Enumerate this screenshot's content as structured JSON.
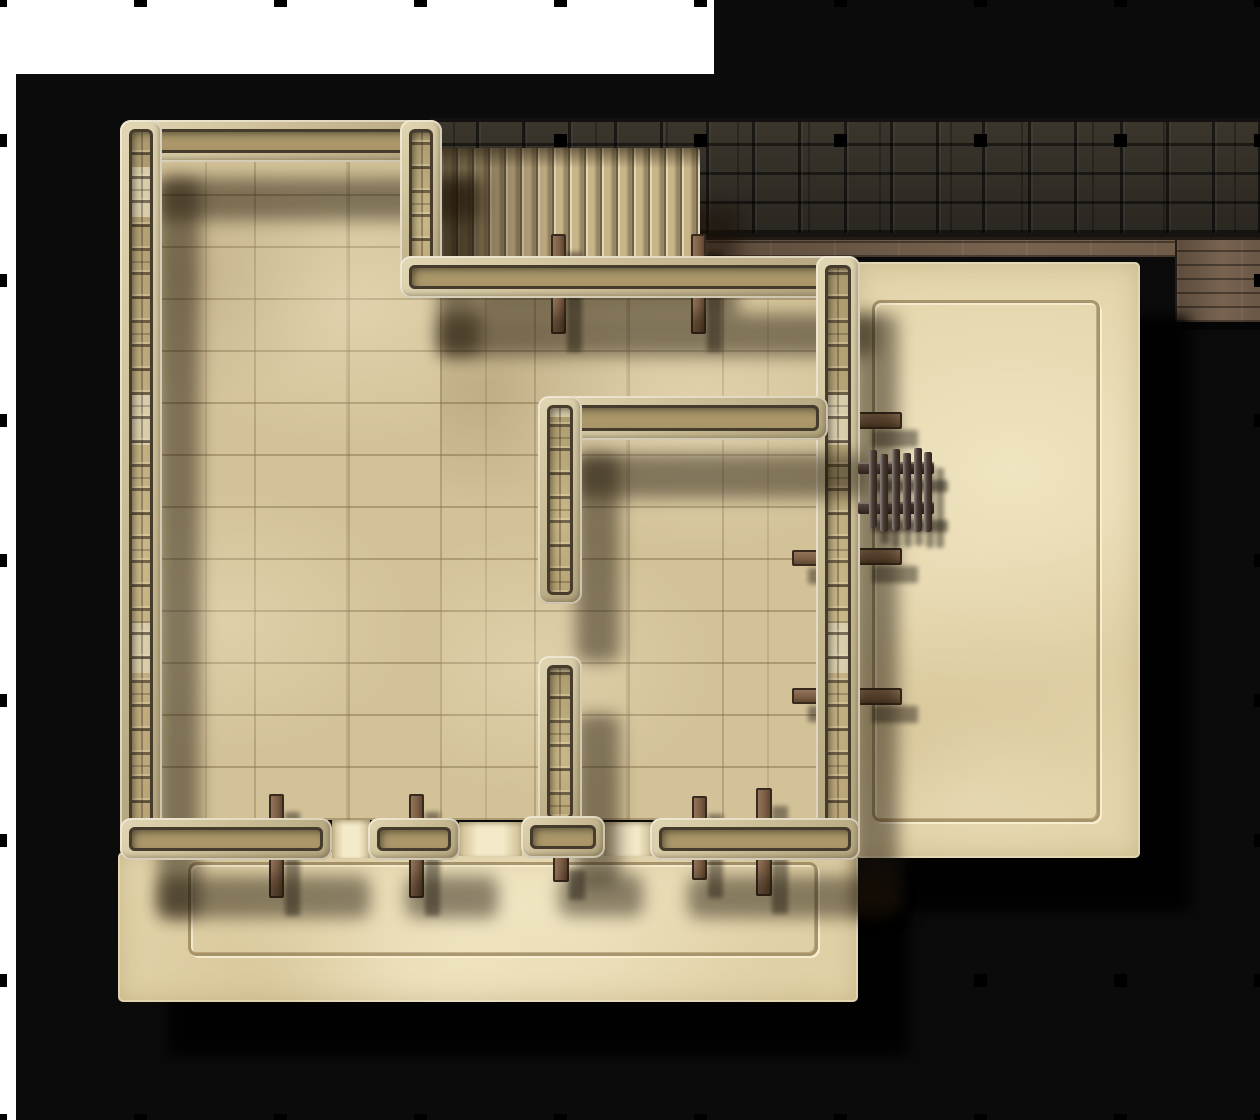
{
  "scene": {
    "description": "Top-down stone keep battle map: large tiled hall with staircase, inner chamber, sandy terrace and walled courtyard, dark stone perimeter wall with wooden walkway, black backdrop with square grid markers",
    "canvas": {
      "width": 1260,
      "height": 1120
    },
    "grid": {
      "cell_px": 140,
      "cols": 9,
      "rows": 8,
      "marker_size_px": 13,
      "marker_color": "#000000"
    },
    "background": {
      "page_color": "#ffffff",
      "backdrop_color": "#0b0b0b",
      "white_top_band": {
        "x": 0,
        "y": 0,
        "w": 714,
        "h": 74
      },
      "white_left_strip_w": 16
    }
  },
  "palette": {
    "floor_tile": "#d3c298",
    "floor_sand": "#e3d4aa",
    "wall_stone_light": "#e2d7b4",
    "wall_brick": "#ab9769",
    "wall_seam": "#453c2d",
    "perimeter_brick": "#322d25",
    "walkway_wood": "#6b5949",
    "post_wood": "#7a5d44",
    "fence_wood": "#3c2e28",
    "shadow": "#000000"
  },
  "layers": {
    "below_grid": [
      {
        "name": "backdrop-main",
        "cls": "bg-black",
        "rect": [
          16,
          74,
          1244,
          1046
        ]
      },
      {
        "name": "backdrop-top-right",
        "cls": "bg-black",
        "rect": [
          714,
          0,
          546,
          74
        ]
      },
      {
        "name": "perimeter-brick-wall",
        "cls": "brick-band",
        "rect": [
          430,
          118,
          830,
          120
        ]
      },
      {
        "name": "wood-walkway",
        "cls": "wood",
        "rect": [
          706,
          237,
          554,
          20
        ]
      },
      {
        "name": "wood-walkway-block",
        "cls": "wood wood-block",
        "rect": [
          1175,
          237,
          85,
          85
        ]
      }
    ],
    "above_grid": [
      {
        "name": "main-hall-floor-west",
        "cls": "floor-tiles",
        "rect": [
          160,
          160,
          280,
          660
        ]
      },
      {
        "name": "main-hall-floor-east",
        "cls": "floor-tiles",
        "rect": [
          440,
          298,
          380,
          522
        ]
      },
      {
        "name": "terrace-floor",
        "cls": "floor-sand shadow-big",
        "rect": [
          118,
          852,
          740,
          150
        ]
      },
      {
        "name": "courtyard-floor",
        "cls": "floor-sand shadow-big",
        "rect": [
          855,
          262,
          285,
          596
        ]
      },
      {
        "name": "terrace-groove-border",
        "cls": "groove",
        "rect": [
          188,
          862,
          630,
          94
        ]
      },
      {
        "name": "courtyard-groove-border",
        "cls": "groove",
        "rect": [
          872,
          300,
          228,
          522
        ]
      },
      {
        "name": "door-threshold-west",
        "cls": "threshold",
        "rect": [
          332,
          820,
          38,
          38
        ]
      },
      {
        "name": "door-threshold-middle",
        "cls": "threshold",
        "rect": [
          459,
          822,
          63,
          34
        ]
      },
      {
        "name": "door-threshold-east",
        "cls": "threshold",
        "rect": [
          604,
          822,
          48,
          34
        ]
      },
      {
        "name": "staircase",
        "cls": "stairs shadow-wall",
        "rect": [
          442,
          148,
          258,
          110
        ]
      },
      {
        "name": "post-north-1",
        "cls": "post",
        "rect": [
          551,
          234,
          15,
          100
        ]
      },
      {
        "name": "post-north-2",
        "cls": "post",
        "rect": [
          691,
          234,
          15,
          100
        ]
      },
      {
        "name": "post-south-1",
        "cls": "post",
        "rect": [
          269,
          794,
          15,
          104
        ]
      },
      {
        "name": "post-south-2",
        "cls": "post",
        "rect": [
          409,
          794,
          15,
          104
        ]
      },
      {
        "name": "post-south-3",
        "cls": "post",
        "rect": [
          553,
          852,
          16,
          30
        ]
      },
      {
        "name": "post-south-4",
        "cls": "post",
        "rect": [
          692,
          796,
          15,
          84
        ]
      },
      {
        "name": "post-south-5",
        "cls": "post",
        "rect": [
          756,
          788,
          16,
          108
        ]
      },
      {
        "name": "beam-east-outer-1",
        "cls": "post post-h",
        "rect": [
          856,
          412,
          46,
          17
        ]
      },
      {
        "name": "beam-east-outer-2",
        "cls": "post post-h",
        "rect": [
          856,
          548,
          46,
          17
        ]
      },
      {
        "name": "beam-east-inner-1",
        "cls": "post post-h",
        "rect": [
          792,
          550,
          28,
          16
        ]
      },
      {
        "name": "beam-east-inner-2",
        "cls": "post post-h",
        "rect": [
          792,
          688,
          28,
          16
        ]
      },
      {
        "name": "beam-east-outer-3",
        "cls": "post post-h",
        "rect": [
          856,
          688,
          46,
          17
        ]
      },
      {
        "name": "wall-north",
        "cls": "wall wall-h",
        "rect": [
          120,
          120,
          322,
          42
        ]
      },
      {
        "name": "wall-west",
        "cls": "wall wall-v",
        "rect": [
          120,
          120,
          42,
          740
        ]
      },
      {
        "name": "wall-stair-west",
        "cls": "wall wall-v",
        "rect": [
          400,
          120,
          42,
          178
        ]
      },
      {
        "name": "wall-below-stairs",
        "cls": "wall wall-h",
        "rect": [
          400,
          256,
          438,
          42
        ]
      },
      {
        "name": "wall-east",
        "cls": "wall wall-v",
        "rect": [
          816,
          256,
          44,
          604
        ]
      },
      {
        "name": "wall-south-1",
        "cls": "wall wall-h",
        "rect": [
          120,
          818,
          212,
          42
        ]
      },
      {
        "name": "wall-south-2",
        "cls": "wall wall-h",
        "rect": [
          368,
          818,
          92,
          42
        ]
      },
      {
        "name": "wall-south-3",
        "cls": "wall wall-h",
        "rect": [
          650,
          818,
          210,
          42
        ]
      },
      {
        "name": "inner-wall-north",
        "cls": "wall wall-h",
        "rect": [
          538,
          396,
          290,
          44
        ]
      },
      {
        "name": "inner-wall-west-upper",
        "cls": "wall wall-v",
        "rect": [
          538,
          396,
          44,
          208
        ]
      },
      {
        "name": "inner-wall-west-lower",
        "cls": "wall wall-v",
        "rect": [
          538,
          656,
          44,
          172
        ]
      },
      {
        "name": "inner-wall-south-base",
        "cls": "wall wall-h",
        "rect": [
          521,
          816,
          84,
          42
        ]
      },
      {
        "name": "fence-rail-top",
        "cls": "fence-rail",
        "rect": [
          858,
          462,
          76,
          12
        ]
      },
      {
        "name": "fence-rail-bottom",
        "cls": "fence-rail",
        "rect": [
          858,
          502,
          76,
          12
        ]
      },
      {
        "name": "fence-picket",
        "cls": "fence-picket",
        "rect": [
          869,
          450,
          8,
          78
        ]
      },
      {
        "name": "fence-picket",
        "cls": "fence-picket",
        "rect": [
          880,
          454,
          8,
          78
        ]
      },
      {
        "name": "fence-picket",
        "cls": "fence-picket",
        "rect": [
          892,
          449,
          8,
          82
        ]
      },
      {
        "name": "fence-picket",
        "cls": "fence-picket",
        "rect": [
          903,
          453,
          8,
          77
        ]
      },
      {
        "name": "fence-picket",
        "cls": "fence-picket",
        "rect": [
          914,
          448,
          8,
          84
        ]
      },
      {
        "name": "fence-picket",
        "cls": "fence-picket",
        "rect": [
          924,
          452,
          8,
          80
        ]
      }
    ]
  }
}
